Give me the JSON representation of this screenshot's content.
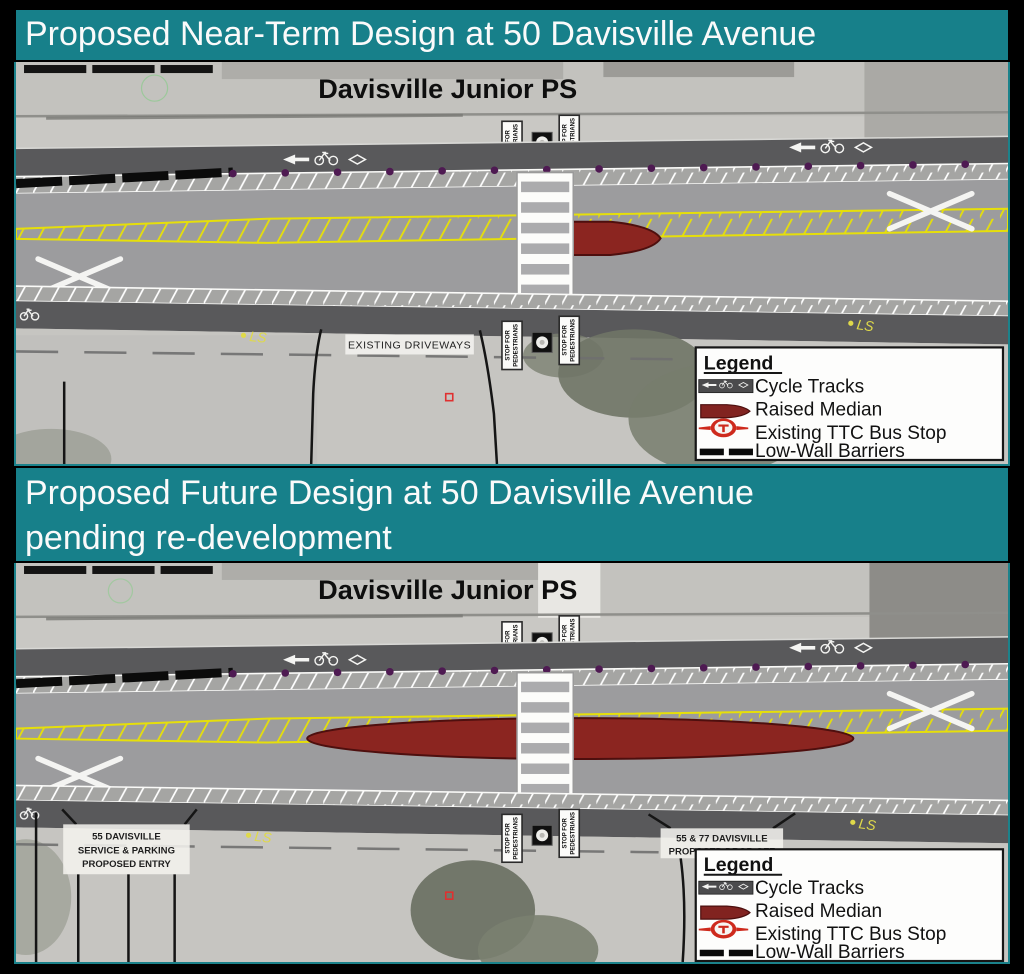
{
  "banner1": {
    "title": "Proposed Near-Term Design at 50 Davisville Avenue"
  },
  "banner2": {
    "line1": "Proposed Future Design at 50 Davisville Avenue",
    "line2": "pending re-development"
  },
  "sign": {
    "line1": "STOP FOR",
    "line2": "PEDESTRIANS"
  },
  "diagram1": {
    "school": "Davisville Junior PS",
    "driveways_label": "EXISTING DRIVEWAYS",
    "ls_annotation": "LS"
  },
  "diagram2": {
    "school": "Davisville Junior PS",
    "entry1": "55 DAVISVILLE",
    "entry2": "SERVICE & PARKING",
    "entry3": "PROPOSED ENTRY",
    "dropoff1": "55 & 77 DAVISVILLE",
    "dropoff2": "PROPOSED DROP-OFF",
    "ls_annotation": "LS"
  },
  "legend": {
    "title": "Legend",
    "items": [
      "Cycle Tracks",
      "Raised Median",
      "Existing TTC Bus Stop",
      "Low-Wall Barriers"
    ]
  },
  "colors": {
    "banner_teal": "#17808A",
    "road_gray": "#9C9C9E",
    "cycle_track_dark": "#59595B",
    "raised_median_red": "#8B2520",
    "median_outline": "#4E0F0E",
    "hatch_yellow": "#E6DF0A",
    "bollard_purple": "#4E1A52",
    "photo_gray": "#C9C8C4",
    "ttc_red": "#CE2A1D",
    "annotation_yellow": "#DFD94A"
  }
}
